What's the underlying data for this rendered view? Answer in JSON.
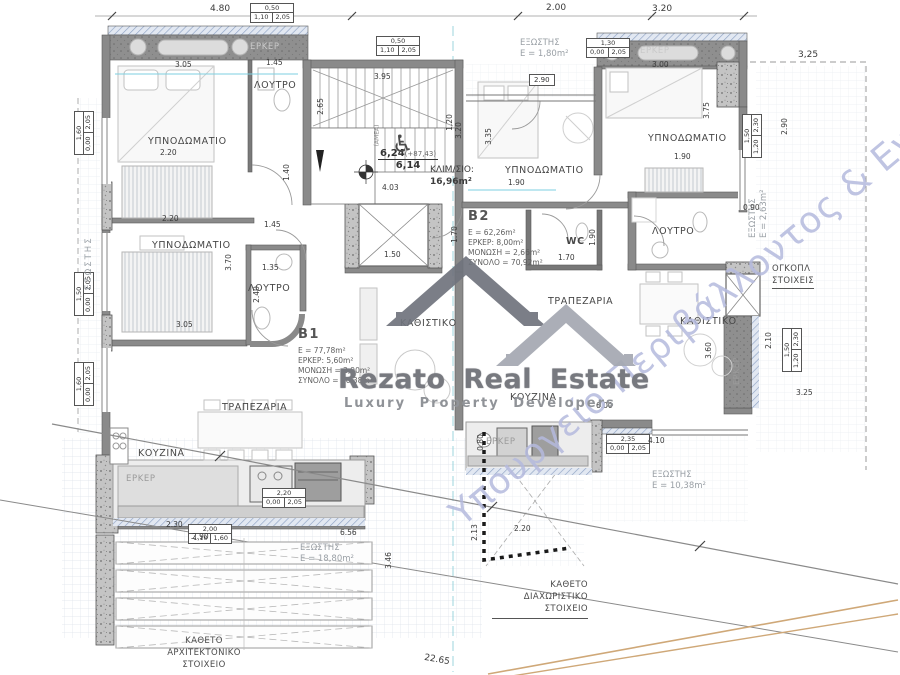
{
  "watermark": {
    "brand": "Rezato Real Estate",
    "tagline": "Luxury Property Developers",
    "ministry": "Υπουργείο Περιβάλλοντος & Ενέργειας"
  },
  "icons": {
    "wheelchair": "♿"
  },
  "units": {
    "b1": {
      "name": "B1",
      "area": "E = 77,78m²",
      "erker": "ΕΡΚΕΡ: 5,60m²",
      "insulation": "ΜΟΝΩΣΗ = 2,90m²",
      "total": "ΣΥΝΟΛΟ = 86,38m²"
    },
    "b2": {
      "name": "B2",
      "area": "E = 62,26m²",
      "erker": "ΕΡΚΕΡ: 8,00m²",
      "insulation": "ΜΟΝΩΣΗ = 2,66m²",
      "total": "ΣΥΝΟΛΟ = 70,92m²"
    }
  },
  "stair": {
    "level_upper": "6,24",
    "level_ref": "(+87,43)",
    "level_lower": "6,14",
    "label": "ΚΛΙΜ/ΣΙΟ:",
    "area": "16,96m²",
    "amea": "(ΑΜΕΑ)"
  },
  "labels": {
    "bedroom": "ΥΠΝΟΔΩΜΑΤΙΟ",
    "bath": "ΛΟΥΤΡΟ",
    "wc": "WC",
    "dining": "ΤΡΑΠΕΖΑΡΙΑ",
    "living": "ΚΑΘΙΣΤΙΚΟ",
    "kitchen": "ΚΟΥΖΙΝΑ",
    "erker": "ΕΡΚΕΡ",
    "balcony": "ΕΞΩΣΤΗΣ"
  },
  "balconies": {
    "top": "Ε = 1,80m²",
    "right": "Ε = 2,63m²",
    "bottom_right": "Ε = 10,38m²",
    "bottom_left": "Ε = 18,80m²"
  },
  "notes": {
    "divider_line1": "ΚΑΘΕΤΟ ΔΙΑΧΩΡΙΣΤΙΚΟ",
    "divider_line2": "ΣΤΟΙΧΕΙΟ",
    "arch_line1": "ΚΑΘΕΤΟ",
    "arch_line2": "ΑΡΧΙΤΕΚΤΟΝΙΚΟ",
    "arch_line3": "ΣΤΟΙΧΕΙΟ",
    "volume_line1": "ΟΓΚΟΠΛ",
    "volume_line2": "ΣΤΟΙΧΕΙΣ"
  },
  "dims": {
    "t480": "4.80",
    "t200": "2.00",
    "t320": "3.20",
    "t325": "3,25",
    "a305": "3.05",
    "a145": "1.45",
    "a395": "3.95",
    "a290": "2.90",
    "a300": "3.00",
    "b220a": "2.20",
    "b370": "3.70",
    "b220b": "2.20",
    "b305": "3.05",
    "b135": "1.35",
    "b240": "2.40",
    "b140": "1.40",
    "b145": "1.45",
    "b265": "2.65",
    "s320": "3.20",
    "s335": "3.35",
    "s403": "4.03",
    "s150": "1.50",
    "s120": "1.20",
    "c190a": "1.90",
    "c190b": "1.90",
    "c375": "3.75",
    "c170a": "1.70",
    "c170b": "1.70",
    "c190c": "1.90",
    "r090": "0.90",
    "r290": "2.90",
    "r360": "3.60",
    "r210": "2.10",
    "r325": "3.25",
    "k600": "6.00",
    "k410": "4.10",
    "k080": "0.80",
    "k220": "2.20",
    "k213": "2.13",
    "l230": "2.30",
    "l290": "2.90",
    "l656": "6.56",
    "l346": "3.46",
    "z2265": "22.65"
  },
  "dimboxes": [
    {
      "w": "0,50",
      "sill": "1,10",
      "h": "2,05"
    },
    {
      "w": "0,50",
      "sill": "1,10",
      "h": "2,05"
    },
    {
      "w": "1,30",
      "sill": "0,00",
      "h": "2,05"
    },
    {
      "w": "1,60",
      "sill": "0,00",
      "h": "2,05"
    },
    {
      "w": "1,50",
      "sill": "0,00",
      "h": "2,05"
    },
    {
      "w": "1,60",
      "sill": "0,00",
      "h": "2,05"
    },
    {
      "w": "1,50",
      "sill": "1,20",
      "h": "2,30"
    },
    {
      "w": "1,50",
      "sill": "1,20",
      "h": "2,30"
    },
    {
      "w": "2,35",
      "sill": "0,00",
      "h": "2,05"
    },
    {
      "w": "2,20",
      "sill": "0,00",
      "h": "2,05"
    },
    {
      "w": "2,00",
      "sill": "-1,10",
      "h": "1,60"
    }
  ]
}
